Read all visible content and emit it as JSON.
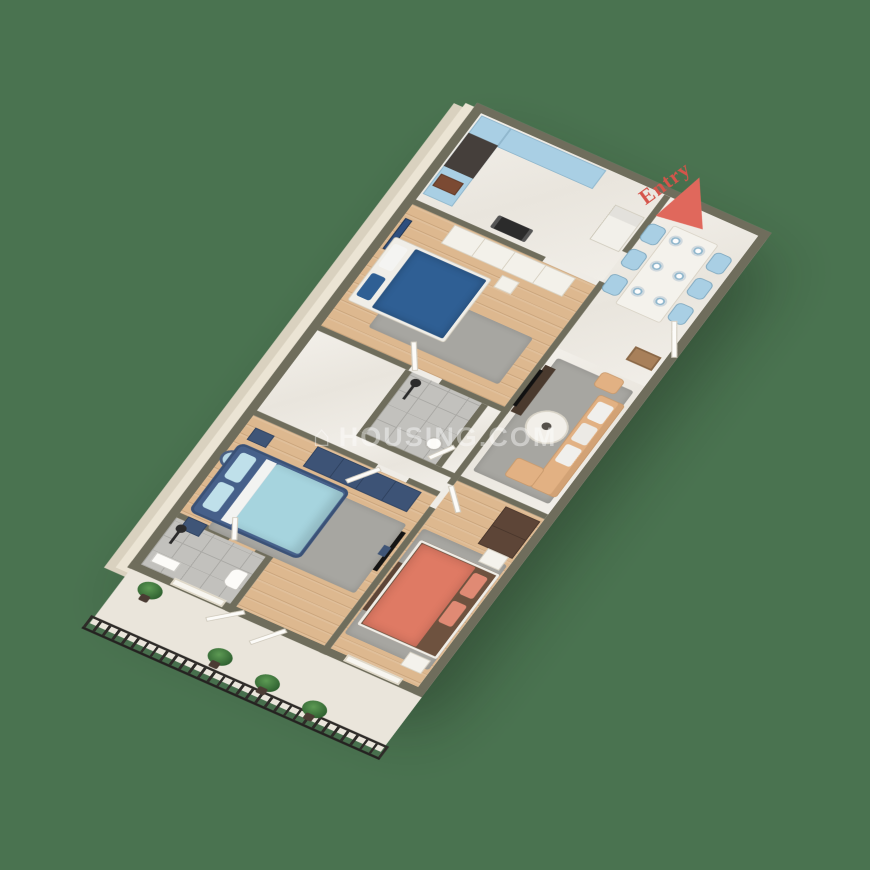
{
  "scene": {
    "type": "3d-isometric-floor-plan-render",
    "background_color": "#4a7350"
  },
  "entry_marker": {
    "label": "Entry",
    "color": "#d5544a",
    "arrow": "red-triangle-pointing-to-entry-door"
  },
  "watermark": {
    "icon_glyph": "⌂",
    "text": "HOUSING.COM"
  },
  "floor_plan": {
    "counts": {
      "bedrooms": 3,
      "bathrooms": 2,
      "balconies": 1,
      "dining_chairs": 6,
      "dining_plates": 6,
      "balcony_plants": 4
    },
    "rooms": [
      {
        "name": "Kitchen",
        "floor": "white-marble",
        "furniture": [
          "light-blue-cabinets",
          "tall-dark-cabinet",
          "sink",
          "gas-stove",
          "refrigerator"
        ]
      },
      {
        "name": "Dining / Foyer",
        "floor": "white-marble",
        "furniture": [
          "marble-dining-table",
          "six-light-blue-chairs",
          "entry-door",
          "doormat"
        ]
      },
      {
        "name": "Living Room",
        "floor": "white-marble",
        "furniture": [
          "tan-l-shaped-sofa",
          "white-cushions",
          "round-coffee-table",
          "gray-rug",
          "dark-tv-console",
          "tan-armchair"
        ]
      },
      {
        "name": "Bedroom 2",
        "floor": "wood",
        "furniture": [
          "dark-blue-double-bed",
          "white-wardrobe",
          "navy-wall-art",
          "white-nightstand",
          "gray-rug"
        ]
      },
      {
        "name": "Master Bedroom",
        "floor": "wood",
        "furniture": [
          "navy-bed-light-blue-bedding",
          "navy-wardrobe",
          "round-wall-mirror",
          "two-nightstands",
          "gray-rug",
          "wall-tv"
        ]
      },
      {
        "name": "Bedroom 3",
        "floor": "wood",
        "furniture": [
          "coral-double-bed",
          "brown-wardrobe",
          "two-white-nightstands",
          "brown-sideboard",
          "gray-rug"
        ]
      },
      {
        "name": "Bathroom 1",
        "floor": "gray-tile",
        "furniture": [
          "shower",
          "toilet",
          "washbasin"
        ]
      },
      {
        "name": "Bathroom 2",
        "floor": "gray-tile",
        "furniture": [
          "shower",
          "washbasin"
        ]
      },
      {
        "name": "Balcony",
        "floor": "stone",
        "furniture": [
          "black-metal-railing",
          "four-potted-plants",
          "white-doors",
          "windows"
        ]
      }
    ]
  },
  "palette": {
    "wall_top": "#6f6d5c",
    "wall_face_cream": "#ebe4d4",
    "wood_floor": "#ddb88f",
    "marble_floor": "#efece6",
    "tile_floor": "#c2c1bd",
    "navy": "#3d5376",
    "dark_blue_duvet": "#2f5f94",
    "light_blue": "#a9cfe4",
    "coral": "#df7a64",
    "tan_sofa": "#e2b183",
    "brown_wardrobe": "#5d4537",
    "rug_gray": "#a7a6a1",
    "plant_green": "#3f7d3f",
    "railing_black": "#2e2b28"
  }
}
